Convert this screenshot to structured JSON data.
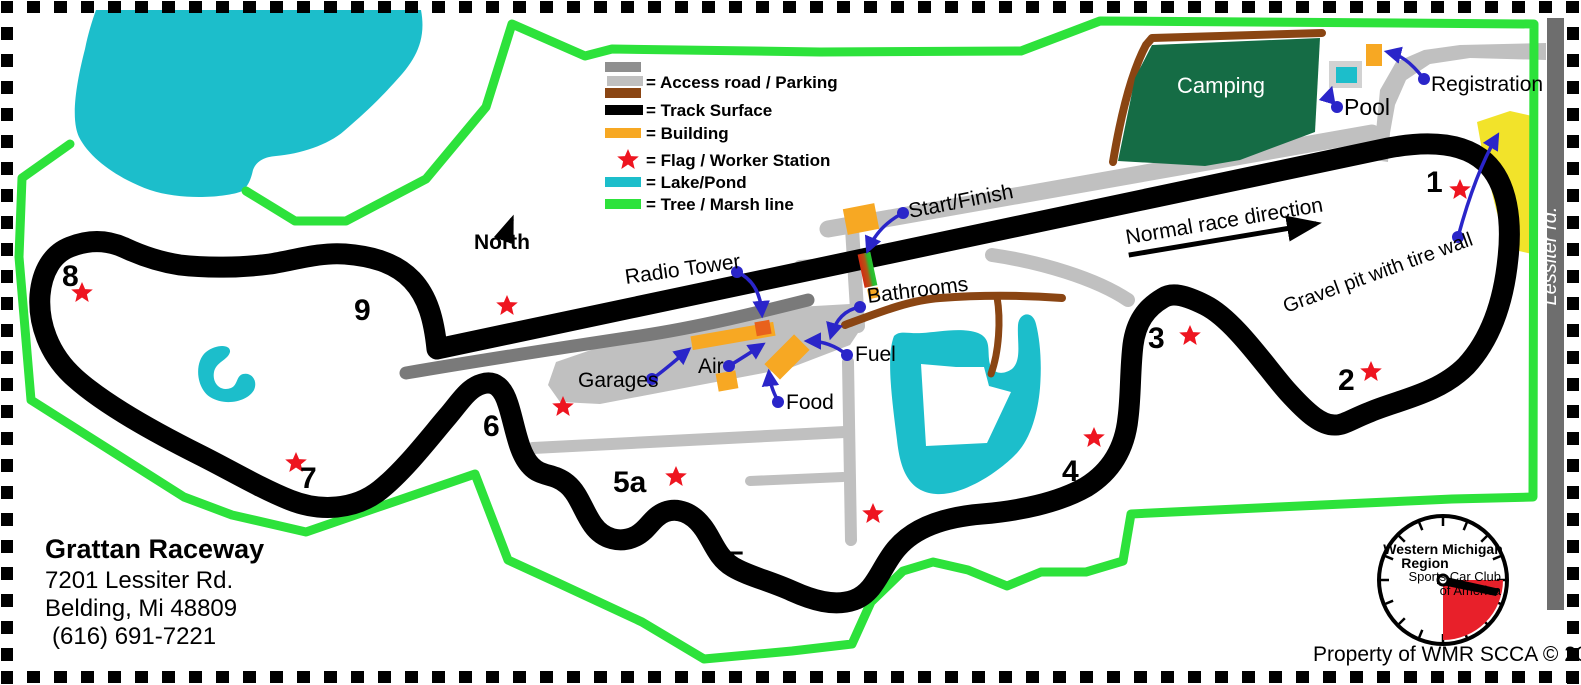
{
  "title_block": {
    "name": "Grattan Raceway",
    "address_line1": "7201 Lessiter Rd.",
    "address_line2": "Belding, Mi 48809",
    "phone": "(616) 691-7221"
  },
  "legend": {
    "items": [
      {
        "swatch": "access-road",
        "label": "= Access road / Parking"
      },
      {
        "swatch": "track-surface",
        "label": "= Track Surface"
      },
      {
        "swatch": "building",
        "label": "= Building"
      },
      {
        "swatch": "flag-star",
        "label": "= Flag / Worker Station"
      },
      {
        "swatch": "lake-pond",
        "label": "= Lake/Pond"
      },
      {
        "swatch": "tree-marsh",
        "label": "= Tree / Marsh line"
      }
    ]
  },
  "compass": {
    "label": "North"
  },
  "race_direction": {
    "label": "Normal race direction"
  },
  "street": {
    "label": "Lessiter rd."
  },
  "areas": {
    "camping": "Camping",
    "pool": "Pool",
    "registration": "Registration",
    "gravel_pit": "Gravel pit with tire wall"
  },
  "facilities": {
    "start_finish": "Start/Finish",
    "radio_tower": "Radio Tower",
    "bathrooms": "Bathrooms",
    "fuel": "Fuel",
    "food": "Food",
    "air": "Air",
    "garages": "Garages"
  },
  "turns": [
    {
      "label": "1"
    },
    {
      "label": "2"
    },
    {
      "label": "3"
    },
    {
      "label": "4"
    },
    {
      "label": "5"
    },
    {
      "label": "5a"
    },
    {
      "label": "6"
    },
    {
      "label": "7"
    },
    {
      "label": "8"
    },
    {
      "label": "9"
    }
  ],
  "logo": {
    "line1": "Western Michigan",
    "line2": "Region",
    "line3": "Sports Car Club",
    "line4": "of America"
  },
  "footer": {
    "text": "Property of WMR SCCA © 2011"
  },
  "colors": {
    "track": "#000000",
    "access_road_medium": "#8f8f8f",
    "access_road_light": "#c0c0c0",
    "access_road_dark": "#6e6e6e",
    "dirt_road_brown": "#8a4513",
    "building_orange": "#f7a823",
    "radio_tower_building": "#e8611c",
    "lake_cyan": "#1cbecb",
    "tree_line_green": "#2de23b",
    "camping_green": "#156c45",
    "gravel_pit_yellow": "#f2e32a",
    "flag_star_red": "#ee1520",
    "pointer_blue": "#2a25c9",
    "start_stripe_red": "#d42a10",
    "start_stripe_green": "#28c830"
  }
}
